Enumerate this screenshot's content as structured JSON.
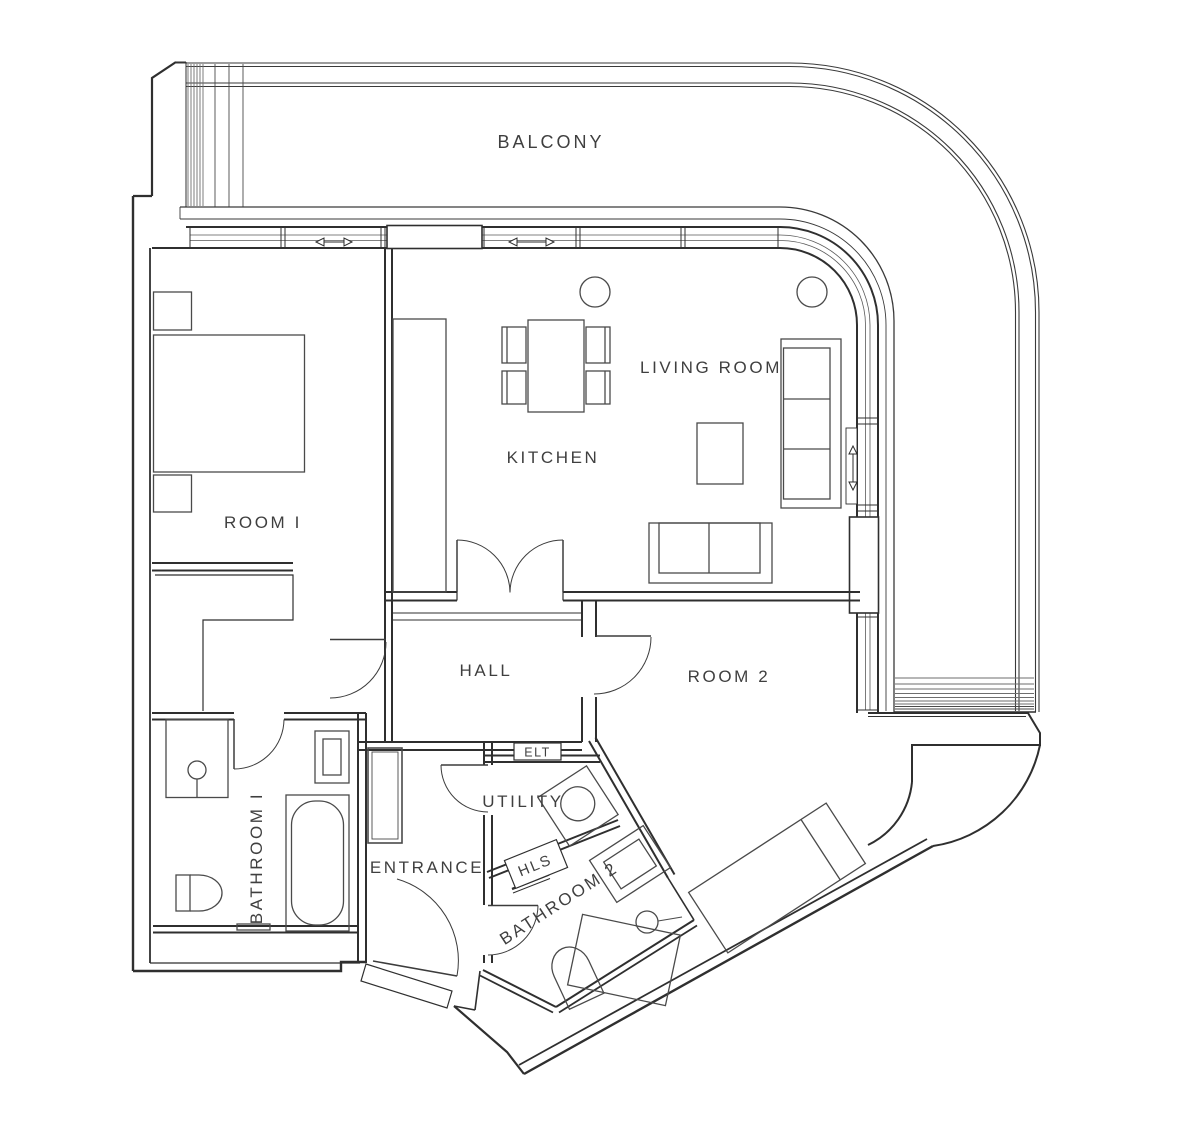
{
  "page": {
    "title": "Apartment floor plan",
    "background": "#ffffff"
  },
  "colors": {
    "wall": "#2f2f2f",
    "structure": "#3a3a3a",
    "furniture": "#4a4a4a",
    "detail": "#6e6e6e",
    "label": "#3f3f3f"
  },
  "labels": {
    "balcony": "BALCONY",
    "room1": "ROOM I",
    "kitchen": "KITCHEN",
    "living_room": "LIVING ROOM",
    "hall": "HALL",
    "room2": "ROOM 2",
    "bathroom1": "BATHROOM I",
    "utility": "UTILITY",
    "entrance": "ENTRANCE",
    "bathroom2": "BATHROOM 2",
    "elt": "ELT",
    "hls": "HLS"
  }
}
